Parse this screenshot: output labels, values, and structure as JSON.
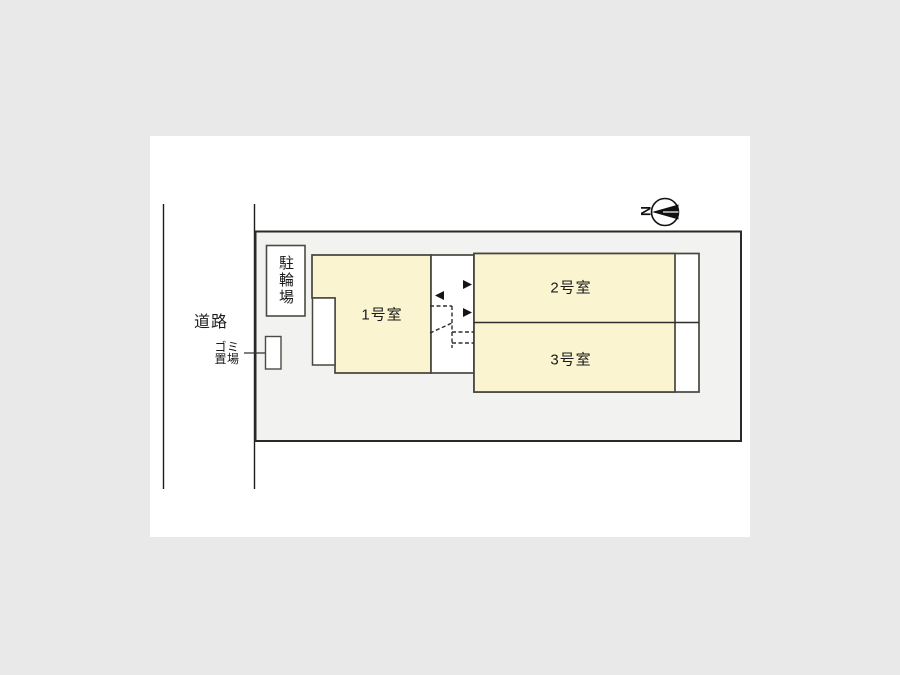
{
  "document": {
    "type": "site-plan-diagram"
  },
  "colors": {
    "canvas_background": "#e9e9e9",
    "page_background": "#ffffff",
    "site_fill": "#f2f2f0",
    "room_fill": "#faf5d0",
    "outline_dark": "#2a2a2a",
    "outline_mid": "#48473f",
    "text": "#1a1a1a",
    "arrow_fill": "#151515"
  },
  "labels": {
    "road": "道路",
    "garbage_line1": "ゴミ",
    "garbage_line2": "置場",
    "bicycle_parking": "駐輪場",
    "room1": "1号室",
    "room2": "2号室",
    "room3": "3号室",
    "compass_north": "N"
  }
}
